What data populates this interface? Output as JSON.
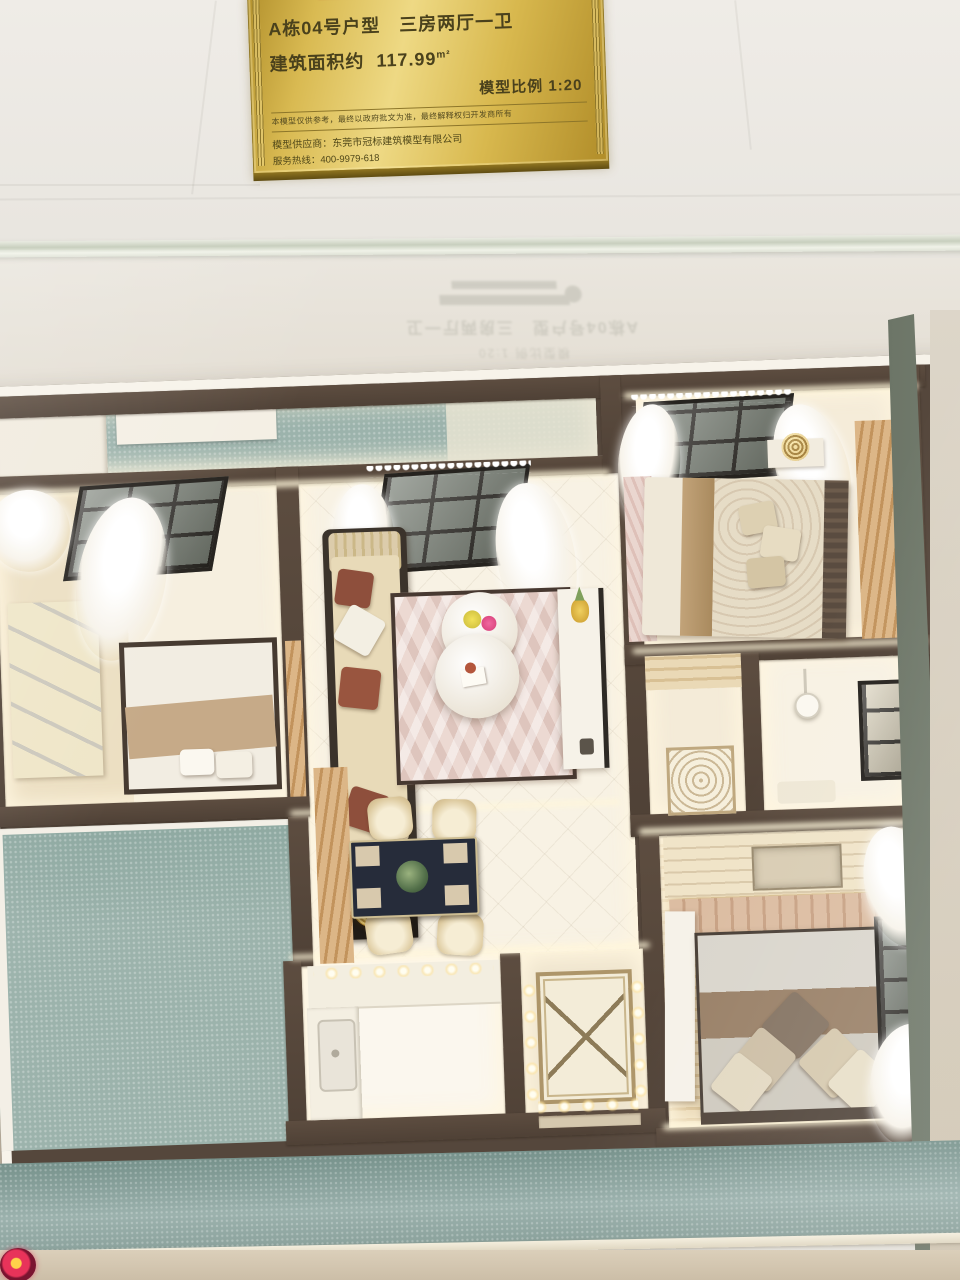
{
  "plaque": {
    "unit_line": "A栋04号户型　三房两厅一卫",
    "area_label": "建筑面积约",
    "area_value": "117.99",
    "area_unit": "m²",
    "scale_line": "模型比例 1:20",
    "disclaimer": "本模型仅供参考，最终以政府批文为准，最终解释权归开发商所有",
    "supplier": "模型供应商：东莞市冠标建筑模型有限公司",
    "hotline": "服务热线：400-9979-618"
  },
  "colors": {
    "plaque_gold": "#d8b84e",
    "plaque_text": "#4a411c",
    "model_wall": "#564639",
    "floor_cream": "#f7f1e2",
    "base_teal": "#93aba6",
    "rug_pink": "#ecd8d2",
    "wood": "#d3ab77",
    "led_warm": "#fff3d6"
  }
}
